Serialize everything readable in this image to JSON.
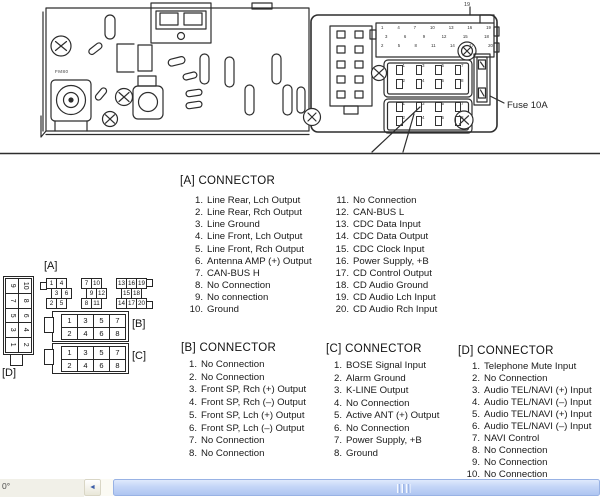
{
  "figure": {
    "fuse_label": "Fuse 10A",
    "pin_tick_label": "19",
    "stamp": "FM80"
  },
  "pin_maps": {
    "a_label": "[A]",
    "b_label": "[B]",
    "c_label": "[C]",
    "d_label": "[D]",
    "a_rows": [
      [
        "1",
        "4",
        "7",
        "10",
        "13",
        "16",
        "19"
      ],
      [
        "3",
        "6",
        "9",
        "12",
        "15",
        "18"
      ],
      [
        "2",
        "5",
        "8",
        "11",
        "14",
        "17",
        "20"
      ]
    ],
    "bc_rows": [
      [
        "1",
        "3",
        "5",
        "7"
      ],
      [
        "2",
        "4",
        "6",
        "8"
      ]
    ],
    "d_rows": [
      [
        "9",
        "10"
      ],
      [
        "7",
        "8"
      ],
      [
        "5",
        "6"
      ],
      [
        "3",
        "4"
      ],
      [
        "1",
        "2"
      ]
    ]
  },
  "sections": {
    "a": {
      "title": "[A] CONNECTOR",
      "left": [
        [
          "1.",
          "Line Rear, Lch Output"
        ],
        [
          "2.",
          "Line Rear, Rch Output"
        ],
        [
          "3.",
          "Line Ground"
        ],
        [
          "4.",
          "Line Front, Lch Output"
        ],
        [
          "5.",
          "Line Front, Rch Output"
        ],
        [
          "6.",
          "Antenna AMP (+) Output"
        ],
        [
          "7.",
          "CAN-BUS H"
        ],
        [
          "8.",
          "No Connection"
        ],
        [
          "9.",
          "No connection"
        ],
        [
          "10.",
          "Ground"
        ]
      ],
      "right": [
        [
          "11.",
          "No Connection"
        ],
        [
          "12.",
          "CAN-BUS L"
        ],
        [
          "13.",
          "CDC Data Input"
        ],
        [
          "14.",
          "CDC Data Output"
        ],
        [
          "15.",
          "CDC Clock Input"
        ],
        [
          "16.",
          "Power Supply, +B"
        ],
        [
          "17.",
          "CD Control Output"
        ],
        [
          "18.",
          "CD Audio Ground"
        ],
        [
          "19.",
          "CD Audio Lch Input"
        ],
        [
          "20.",
          "CD Audio Rch Input"
        ]
      ]
    },
    "b": {
      "title": "[B] CONNECTOR",
      "items": [
        [
          "1.",
          "No Connection"
        ],
        [
          "2.",
          "No Connection"
        ],
        [
          "3.",
          "Front SP, Rch (+) Output"
        ],
        [
          "4.",
          "Front SP, Rch (–) Output"
        ],
        [
          "5.",
          "Front SP, Lch (+) Output"
        ],
        [
          "6.",
          "Front SP, Lch (–) Output"
        ],
        [
          "7.",
          "No Connection"
        ],
        [
          "8.",
          "No Connection"
        ]
      ]
    },
    "c": {
      "title": "[C] CONNECTOR",
      "items": [
        [
          "1.",
          "BOSE Signal Input"
        ],
        [
          "2.",
          "Alarm Ground"
        ],
        [
          "3.",
          "K-LINE Output"
        ],
        [
          "4.",
          "No Connection"
        ],
        [
          "5.",
          "Active ANT (+) Output"
        ],
        [
          "6.",
          "No Connection"
        ],
        [
          "7.",
          "Power Supply, +B"
        ],
        [
          "8.",
          "Ground"
        ]
      ]
    },
    "d": {
      "title": "[D] CONNECTOR",
      "items": [
        [
          "1.",
          "Telephone Mute Input"
        ],
        [
          "2.",
          "No Connection"
        ],
        [
          "3.",
          "Audio TEL/NAVI (+) Input"
        ],
        [
          "4.",
          "Audio TEL/NAVI (–) Input"
        ],
        [
          "5.",
          "Audio TEL/NAVI (+) Input"
        ],
        [
          "6.",
          "Audio TEL/NAVI (–) Input"
        ],
        [
          "7.",
          "NAVI Control"
        ],
        [
          "8.",
          "No Connection"
        ],
        [
          "9.",
          "No Connection"
        ],
        [
          "10.",
          "No Connection"
        ]
      ]
    }
  },
  "statusbar": {
    "fragment": "0°",
    "left_arrow": "◄"
  },
  "colors": {
    "ink": "#2d2d2d",
    "scroll_thumb": "#b9cdf4",
    "scroll_thumb_border": "#98b2e4",
    "scroll_track": "#fbfaf3",
    "status_bg": "#f1f0e8"
  }
}
